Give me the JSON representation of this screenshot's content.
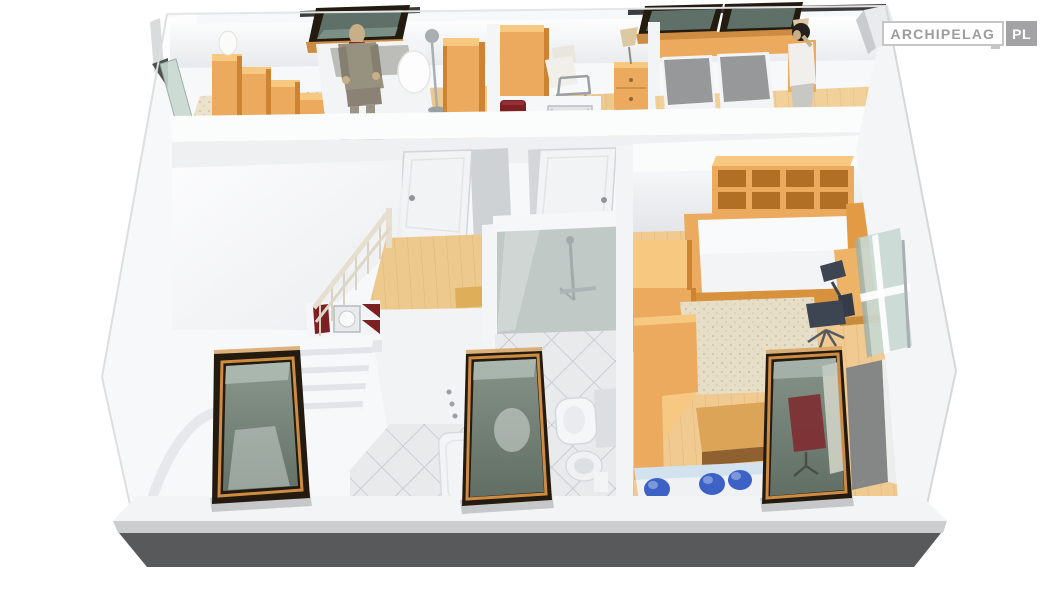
{
  "logo": {
    "brand": "ARCHIPELAG",
    "tld": "PL"
  },
  "palette": {
    "wood": "#ebaa5d",
    "woodTop": "#f7c87f",
    "woodDark": "#cd8331",
    "woodDeep": "#b06f25",
    "floorWood": "#eec98e",
    "floorPale": "#f6ead4",
    "carpet": "#ece1cb",
    "rug": "#e7dec7",
    "wall": "#f7f8f9",
    "wallShade": "#e7e9eb",
    "wallDark": "#d8dadc",
    "tile": "#e8eaec",
    "tileLine": "#c2c6ca",
    "glassGreen": "#7f9086",
    "glassPale": "#c8d8d1",
    "frameDark": "#231a10",
    "frameOrange": "#cd8c42",
    "baseDark": "#58595b",
    "baseMid": "#cbcdcf",
    "fascia": "#f3f4f5",
    "blanket": "#96989a",
    "mattress": "#f3f4f6",
    "matSide": "#d8dadc",
    "maroon": "#7d2022",
    "blue": "#3e61c6",
    "blueHi": "#7b98dd",
    "paleBlue": "#d3e2ef",
    "chrome": "#a9aeb2",
    "doorWhite": "#f2f3f5",
    "doorEdge": "#d2d5d8",
    "figGray": "#97917f",
    "figDark": "#35322e",
    "skin": "#c9af87",
    "navy": "#3d4552",
    "chairRed": "#7e3034",
    "logoGray": "#9c9c9c",
    "logoBorder": "#c6c6c6",
    "logoPlBg": "#a3a3a5"
  },
  "scene": {
    "type": "3d-cutaway-attic-floor-plan",
    "rooms": [
      {
        "name": "study-bedroom-top-left",
        "objects": [
          "stepped-bookshelf",
          "egg-lamp",
          "daybed",
          "seated-mannequin",
          "blue-pouf",
          "egg-floor-lamp",
          "wardrobe",
          "gable-window",
          "roof-window"
        ]
      },
      {
        "name": "dressing-room-top-center",
        "objects": [
          "wardrobe",
          "armchair",
          "directors-chair",
          "maroon-tray",
          "ornate-frame",
          "nightstand",
          "table-lamp"
        ]
      },
      {
        "name": "bedroom-top-right",
        "objects": [
          "twin-bed-left",
          "twin-bed-right",
          "gray-blankets",
          "nightstand-left",
          "nightstand-right",
          "table-lamps",
          "standing-mannequin",
          "roof-window-left",
          "roof-window-right"
        ]
      },
      {
        "name": "landing-staircase",
        "objects": [
          "staircase",
          "stair-railing",
          "white-door-left",
          "white-door-right",
          "washbasin-counter",
          "maroon-towels",
          "ornate-basin",
          "chest-of-drawers",
          "doormat"
        ]
      },
      {
        "name": "bathroom",
        "objects": [
          "shower-enclosure",
          "shower-set",
          "bathtub",
          "toilet",
          "bidet",
          "diamond-tile-floor",
          "roof-window"
        ]
      },
      {
        "name": "bedroom-study-right",
        "objects": [
          "cube-wall-shelf",
          "double-bed",
          "wardrobe",
          "beige-rug",
          "desk",
          "desk-lamp",
          "office-chair",
          "wooden-table",
          "blue-bolster-shelf",
          "balcony-window",
          "glass-door",
          "roof-window"
        ]
      }
    ]
  }
}
